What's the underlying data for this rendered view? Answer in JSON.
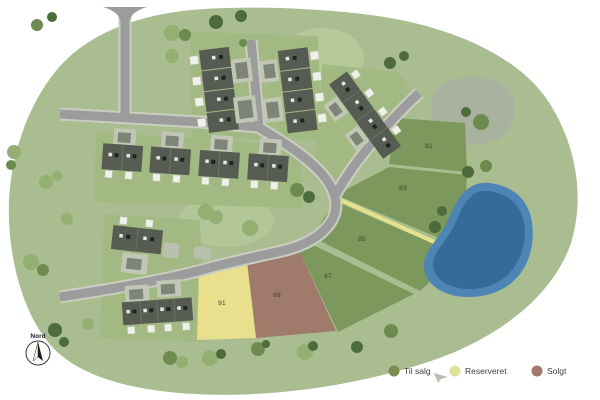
{
  "title": "Udstykningsplan",
  "compass": {
    "label": "Nord"
  },
  "plots": [
    {
      "number": "81",
      "status": "til_salg"
    },
    {
      "number": "83",
      "status": "til_salg"
    },
    {
      "number": "85",
      "status": "til_salg"
    },
    {
      "number": "87",
      "status": "til_salg"
    },
    {
      "number": "89",
      "status": "solgt"
    },
    {
      "number": "91",
      "status": "reserveret"
    }
  ],
  "legend": {
    "items": [
      {
        "label": "Til salg",
        "color": "#7d8b51"
      },
      {
        "label": "Reserveret",
        "color": "#dee198"
      },
      {
        "label": "Solgt",
        "color": "#a2786d"
      }
    ]
  },
  "colors": {
    "terrain": "#a9bd90",
    "parcel": "#a3b983",
    "plot_til_salg": "#7c985c",
    "plot_reserveret": "#e9e08d",
    "plot_solgt": "#a07a6b",
    "path_yellow": "#e6e28c",
    "road": "#9c9c9c",
    "pond_edge": "#4d86b4",
    "pond_deep": "#356b99",
    "hill": "#a8b29f"
  }
}
